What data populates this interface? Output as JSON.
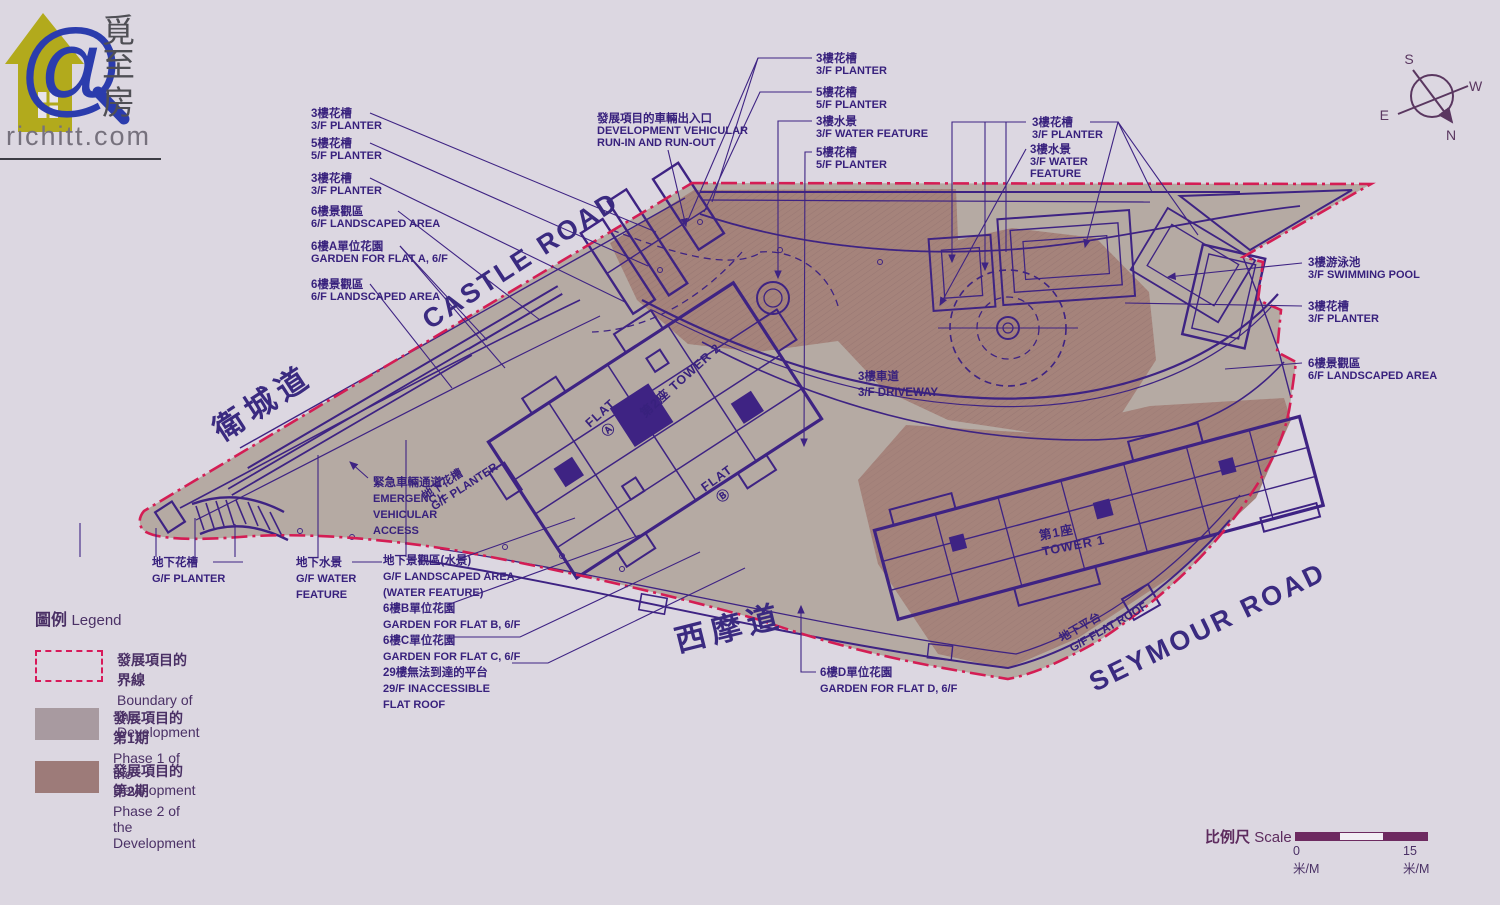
{
  "logo": {
    "site": "richitt.com",
    "at": "@",
    "chars": [
      "覓",
      "至",
      "房"
    ]
  },
  "compass": {
    "n": "N",
    "s": "S",
    "e": "E",
    "w": "W"
  },
  "roads": {
    "castle_zh": "衛城道",
    "castle_en": "CASTLE ROAD",
    "seymour_zh": "西摩道",
    "seymour_en": "SEYMOUR ROAD"
  },
  "plan": {
    "tower1_zh": "第1座",
    "tower1_en": "TOWER 1",
    "tower2": "第2座  TOWER 2",
    "flat": "FLAT",
    "flat_a": "Ⓐ",
    "flat_b": "Ⓑ",
    "driveway_zh": "3樓車道",
    "driveway_en": "3/F DRIVEWAY",
    "gf_planter_zh": "地下花槽",
    "gf_planter_en": "G/F PLANTER",
    "gf_flat_roof_zh": "地下平台",
    "gf_flat_roof_en": "G/F FLAT ROOF"
  },
  "callouts": {
    "left": [
      {
        "zh": "3樓花槽",
        "en": "3/F PLANTER"
      },
      {
        "zh": "5樓花槽",
        "en": "5/F PLANTER"
      },
      {
        "zh": "3樓花槽",
        "en": "3/F PLANTER"
      },
      {
        "zh": "6樓景觀區",
        "en": "6/F LANDSCAPED AREA"
      },
      {
        "zh": "6樓A單位花園",
        "en": "GARDEN FOR FLAT A, 6/F"
      },
      {
        "zh": "6樓景觀區",
        "en": "6/F LANDSCAPED AREA"
      }
    ],
    "top": [
      {
        "zh": "3樓花槽",
        "en": "3/F PLANTER"
      },
      {
        "zh": "5樓花槽",
        "en": "5/F PLANTER"
      },
      {
        "zh": "3樓水景",
        "en": "3/F WATER FEATURE"
      },
      {
        "zh": "5樓花槽",
        "en": "5/F PLANTER"
      }
    ],
    "dev": {
      "zh": "發展項目的車輛出入口",
      "en1": "DEVELOPMENT VEHICULAR",
      "en2": "RUN-IN AND RUN-OUT"
    },
    "right_top_planter": {
      "zh": "3樓花槽",
      "en": "3/F PLANTER"
    },
    "right_top_water": {
      "zh": "3樓水景",
      "en1": "3/F WATER",
      "en2": "FEATURE"
    },
    "right": [
      {
        "zh": "3樓游泳池",
        "en": "3/F SWIMMING POOL"
      },
      {
        "zh": "3樓花槽",
        "en": "3/F PLANTER"
      },
      {
        "zh": "6樓景觀區",
        "en": "6/F LANDSCAPED AREA"
      }
    ],
    "gf_planter": {
      "zh": "地下花槽",
      "en": "G/F PLANTER"
    },
    "gf_water": {
      "zh": "地下水景",
      "en1": "G/F WATER",
      "en2": "FEATURE"
    },
    "gf_landscaped": {
      "zh": "地下景觀區(水景)",
      "en1": "G/F LANDSCAPED AREA",
      "en2": "(WATER FEATURE)"
    },
    "garden_b": {
      "zh": "6樓B單位花園",
      "en": "GARDEN FOR FLAT B, 6/F"
    },
    "garden_c": {
      "zh": "6樓C單位花園",
      "en": "GARDEN FOR FLAT C, 6/F"
    },
    "roof29": {
      "zh": "29樓無法到達的平台",
      "en1": "29/F INACCESSIBLE",
      "en2": "FLAT ROOF"
    },
    "garden_d": {
      "zh": "6樓D單位花園",
      "en": "GARDEN FOR FLAT D, 6/F"
    },
    "emergency": {
      "zh": "緊急車輛通道",
      "en1": "EMERGENCY",
      "en2": "VEHICULAR",
      "en3": "ACCESS"
    }
  },
  "legend": {
    "title_zh": "圖例",
    "title_en": "Legend",
    "boundary": {
      "zh": "發展項目的界線",
      "en": "Boundary of the Development"
    },
    "phase1": {
      "zh": "發展項目的第1期",
      "en": "Phase 1 of the Development",
      "color": "#a89aa0"
    },
    "phase2": {
      "zh": "發展項目的第2期",
      "en": "Phase 2 of the Development",
      "color": "#9d7b79"
    }
  },
  "scale": {
    "label_zh": "比例尺",
    "label_en": "Scale",
    "start": "0米/M",
    "end": "15米/M"
  },
  "colors": {
    "background": "#dcd7e1",
    "site_fill": "#b5aaa3",
    "phase2_fill": "#a5837b",
    "line_purple": "#3e2383",
    "boundary_red": "#d41d54",
    "label_text": "#38217d"
  }
}
